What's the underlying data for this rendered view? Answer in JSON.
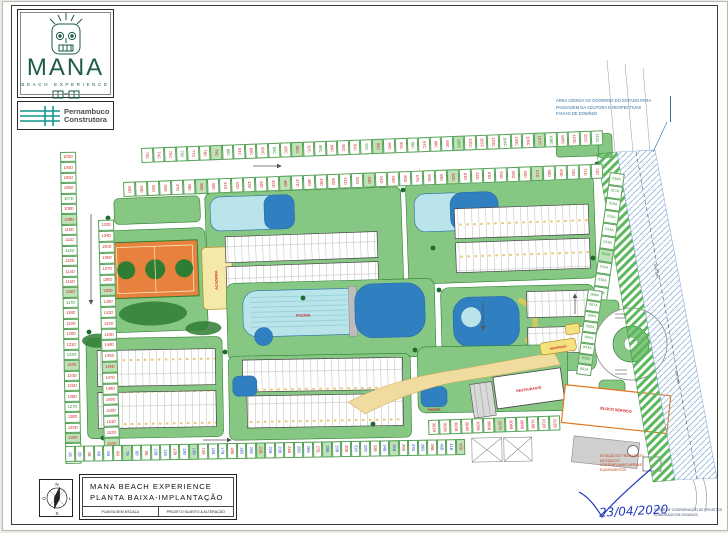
{
  "logo": {
    "brand": "MANA",
    "tagline": "BEACH EXPERIENCE",
    "builder_line1": "Pernambuco",
    "builder_line2": "Construtora"
  },
  "title_block": {
    "line1": "MANA BEACH EXPERIENCE",
    "line2": "PLANTA BAIXA-IMPLANTAÇÃO",
    "sub_left": "PLANTA SEM ESCALA",
    "sub_right": "PROJETO SUJEITO A ALTERAÇÃO"
  },
  "compass": {
    "n": "N",
    "s": "S",
    "e": "L",
    "w": "O"
  },
  "notes": {
    "right_note_lines": [
      "ÁREA CEDIDA AO GOVERNO DO ESTADO PARA",
      "PASSAGEM DA ADUTORA E RESPECTIVAS",
      "FAIXAS DE DOMÍNIO"
    ],
    "ete_lines": [
      "ESTAÇÃO DE TRATAMENTO",
      "DE ESGOTO",
      "CONTEMPLANDO APENAS",
      "EQUIPAMENTOS"
    ],
    "coord_lines": [
      "SETOR DE COORDENAÇÃO DE PROJETOS",
      "ELABORADO EM 23/04/2020"
    ],
    "signature_date": "23/04/2020"
  },
  "plan_labels": {
    "pool_main": "PISCINA",
    "pool_small": "PISCINA",
    "restaurant": "RESTAURANTE",
    "service_block": "BLOCO SERVIÇO",
    "academy": "ACADEMIA",
    "reception": "RECEPÇÃO",
    "band_label": "ADUTORA"
  },
  "colors": {
    "lawn": "#86c883",
    "lawn_edge": "#2e7d32",
    "pool_light": "#b8e4ea",
    "pool_dark": "#2f7fc1",
    "court_orange": "#e8813d",
    "court_green": "#2f7d33",
    "sand": "#f0dc9e",
    "label_red": "#cc2222",
    "hatch_blue": "#8fb3d9",
    "logo_green": "#1c5b46",
    "builder_teal": "#11968c",
    "signature_blue": "#2238c0"
  },
  "parking": {
    "top1": [
      "73C",
      "74C",
      "75C",
      "76C",
      "77C",
      "78C",
      "79C",
      "80C",
      "81C",
      "82C",
      "83C",
      "84C",
      "85C",
      "86C",
      "87C",
      "88C",
      "89C",
      "90C",
      "91C",
      "92C",
      "93C",
      "94C",
      "95C",
      "96C",
      "97C",
      "98C",
      "99C",
      "100C",
      "101C",
      "102C",
      "103C",
      "104C",
      "105C",
      "106C",
      "107C",
      "108C",
      "109C",
      "110C",
      "111C",
      "112C"
    ],
    "top2": [
      "33D",
      "34D",
      "35D",
      "36D",
      "37D",
      "38D",
      "39D",
      "40D",
      "41D",
      "42D",
      "43D",
      "44D",
      "45D",
      "46D",
      "47D",
      "48D",
      "49D",
      "50D",
      "51D",
      "52D",
      "53D",
      "54D",
      "55D",
      "56D",
      "57D",
      "58D",
      "59D",
      "60D",
      "61D",
      "62D",
      "63D",
      "64D",
      "65D",
      "66D",
      "67D",
      "68D",
      "69D",
      "70D",
      "71D",
      "72D"
    ],
    "left1": [
      "103D",
      "104D",
      "105D",
      "106D",
      "107D",
      "108D",
      "109D",
      "110D",
      "111D",
      "112D",
      "113D",
      "114D",
      "115D",
      "116D",
      "117D",
      "118D",
      "119D",
      "120D",
      "121D",
      "122D",
      "123D",
      "124D",
      "125D",
      "126D",
      "127D",
      "128D",
      "129D",
      "130D",
      "131D",
      "132D"
    ],
    "left2": [
      "133D",
      "134D",
      "135D",
      "136D",
      "137D",
      "138D",
      "139D",
      "140D",
      "141D",
      "142D",
      "143D",
      "144D",
      "145D",
      "146D",
      "147D",
      "148D",
      "149D",
      "150D",
      "151D",
      "152D",
      "153D",
      "154D"
    ],
    "bottom": [
      "1B",
      "2B",
      "3B",
      "4B",
      "5B",
      "6B",
      "7B",
      "8B",
      "9B",
      "10B",
      "11B",
      "12B",
      "13B",
      "14B",
      "15B",
      "16B",
      "17B",
      "18B",
      "19B",
      "20B",
      "21B",
      "22B",
      "23B",
      "24B",
      "25B",
      "26B",
      "27B",
      "28B",
      "29B",
      "30B",
      "31B",
      "32B",
      "33B",
      "34B",
      "35B",
      "36B",
      "37B",
      "38B",
      "39B",
      "40B",
      "41B",
      "42B"
    ],
    "mid": [
      "301B",
      "302B",
      "303B",
      "304B",
      "305B",
      "306B",
      "307B",
      "308B",
      "309B",
      "310B",
      "311B",
      "312B"
    ],
    "rightA": [
      "018A",
      "017A",
      "016A",
      "015A",
      "014A",
      "013A",
      "012A",
      "011A",
      "010A",
      "009A"
    ],
    "rightB": [
      "008A",
      "007A",
      "006A",
      "005A",
      "004A",
      "003A",
      "002A",
      "001A"
    ]
  }
}
